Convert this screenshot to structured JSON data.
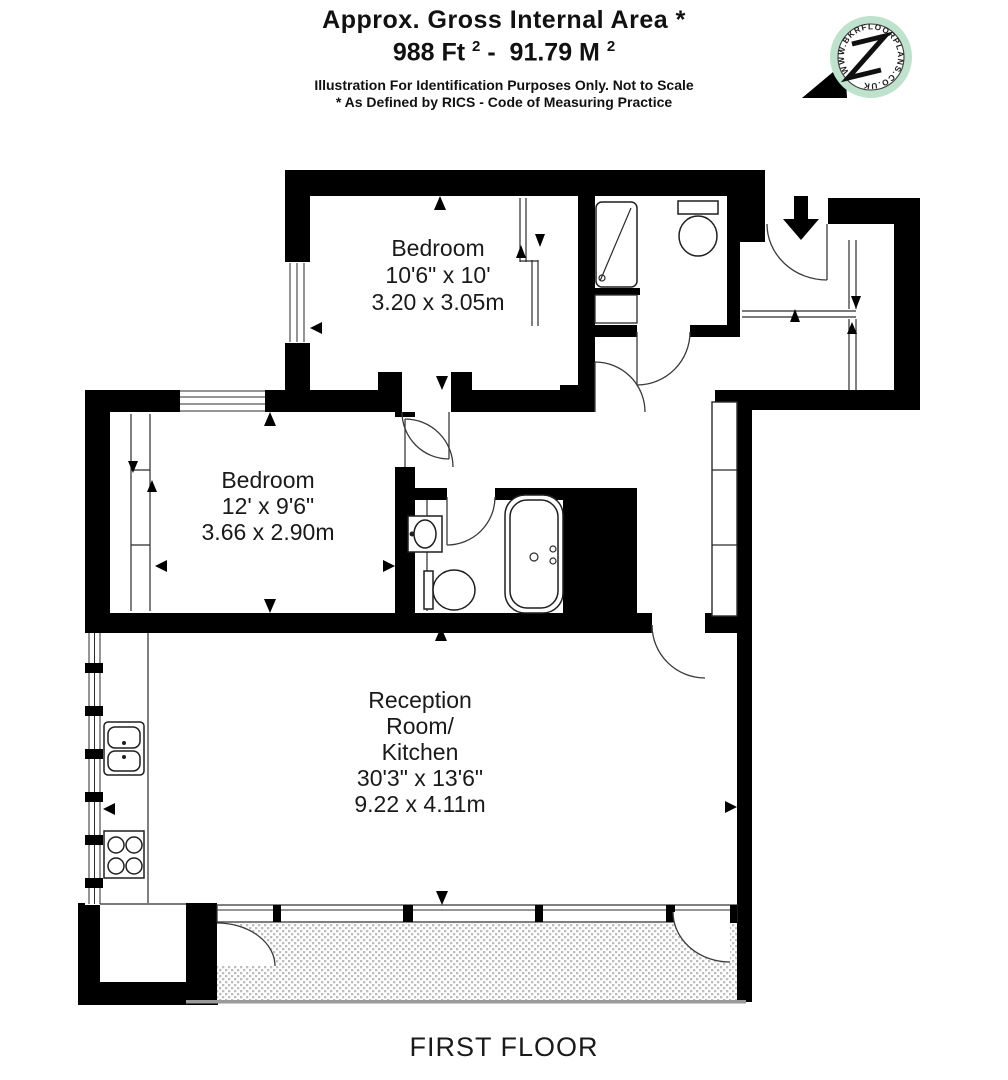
{
  "header": {
    "title": "Approx. Gross Internal Area *",
    "area_ft": "988 Ft ",
    "area_ft_sup": "2",
    "area_sep": " -  ",
    "area_m": "91.79 M ",
    "area_m_sup": "2",
    "disclaimer1": "Illustration For Identification Purposes Only. Not to Scale",
    "disclaimer2": "* As Defined by RICS - Code of Measuring Practice"
  },
  "logo": {
    "ring_text": "WWW.BKRFLOORPLANS.CO.UK"
  },
  "rooms": {
    "bedroom1": {
      "name": "Bedroom",
      "imperial": "10'6\" x 10'",
      "metric": "3.20 x 3.05m"
    },
    "bedroom2": {
      "name": "Bedroom",
      "imperial": "12' x 9'6\"",
      "metric": "3.66 x 2.90m"
    },
    "reception": {
      "name1": "Reception",
      "name2": "Room/",
      "name3": "Kitchen",
      "imperial": "30'3\" x 13'6\"",
      "metric": "9.22 x 4.11m"
    }
  },
  "footer": {
    "floor_label": "FIRST FLOOR"
  },
  "colors": {
    "walls": "#000000",
    "hatch_fill": "#bdbdbd",
    "logo_ring": "#bfe2cd"
  }
}
